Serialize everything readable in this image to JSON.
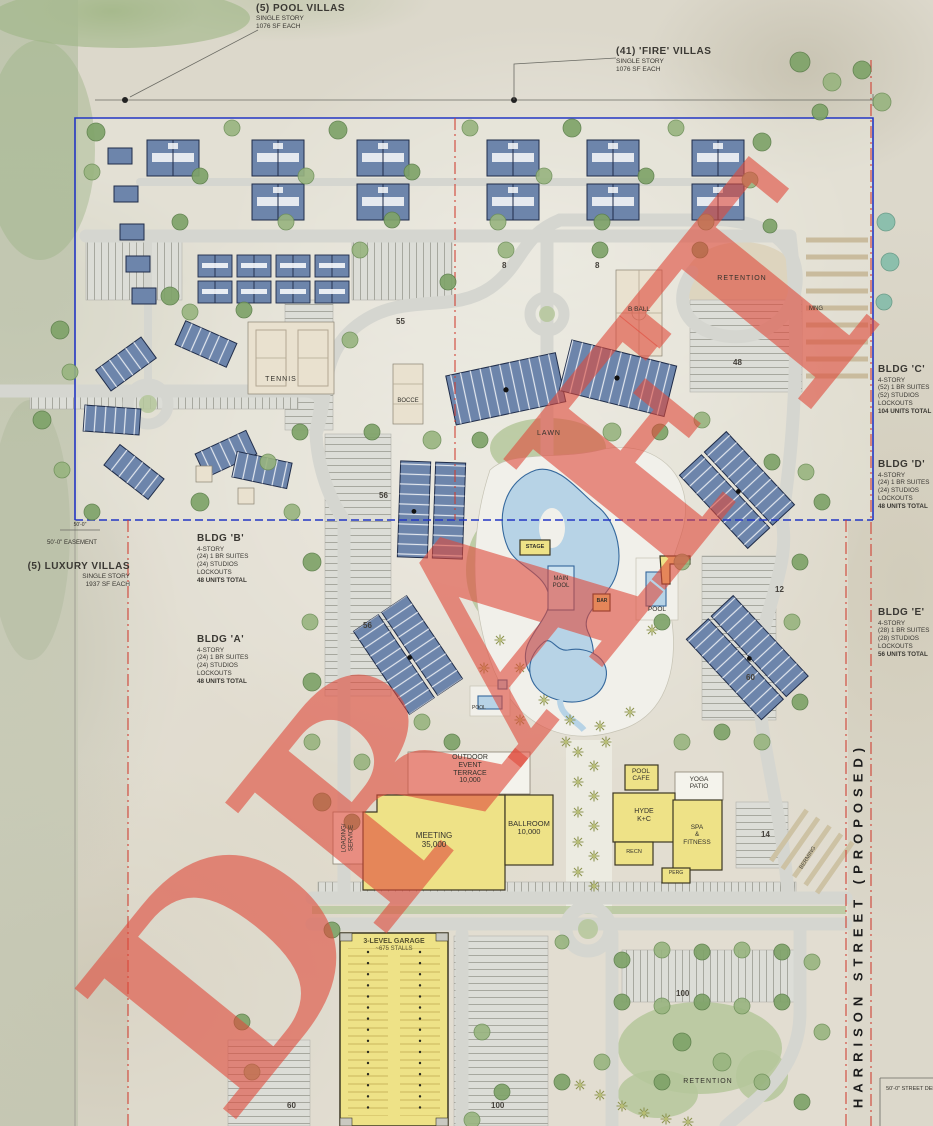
{
  "watermark": {
    "text": "DRAFT"
  },
  "notes": {
    "pool_villas": {
      "title": "(5) POOL VILLAS",
      "sub1": "SINGLE STORY",
      "sub2": "1076 SF EACH"
    },
    "fire_villas": {
      "title": "(41) 'FIRE' VILLAS",
      "sub1": "SINGLE STORY",
      "sub2": "1076 SF EACH"
    },
    "luxury_villas": {
      "title": "(5) LUXURY VILLAS",
      "sub1": "SINGLE STORY",
      "sub2": "1937 SF EACH"
    },
    "easement_dim": "50'-0\"",
    "easement": "50'-0\" EASEMENT",
    "street": "HARRISON STREET (PROPOSED)",
    "street_dedication": "50'-0\" STREET DEDI"
  },
  "building_notes": [
    {
      "name": "BLDG 'A'",
      "story": "4-STORY",
      "suites": "(24) 1 BR SUITES",
      "studios": "(24) STUDIOS",
      "lockouts": "LOCKOUTS",
      "total": "48 UNITS TOTAL"
    },
    {
      "name": "BLDG 'B'",
      "story": "4-STORY",
      "suites": "(24) 1 BR SUITES",
      "studios": "(24) STUDIOS",
      "lockouts": "LOCKOUTS",
      "total": "48 UNITS TOTAL"
    },
    {
      "name": "BLDG 'C'",
      "story": "4-STORY",
      "suites": "(52) 1 BR SUITES",
      "studios": "(52) STUDIOS",
      "lockouts": "LOCKOUTS",
      "total": "104 UNITS TOTAL"
    },
    {
      "name": "BLDG 'D'",
      "story": "4-STORY",
      "suites": "(24) 1 BR SUITES",
      "studios": "(24) STUDIOS",
      "lockouts": "LOCKOUTS",
      "total": "48 UNITS TOTAL"
    },
    {
      "name": "BLDG 'E'",
      "story": "4-STORY",
      "suites": "(28) 1 BR SUITES",
      "studios": "(28) STUDIOS",
      "lockouts": "LOCKOUTS",
      "total": "56 UNITS TOTAL"
    }
  ],
  "amenities": {
    "tennis": "TENNIS",
    "bocce": "BOCCE",
    "bball": "B BALL",
    "retention": "RETENTION",
    "mng": "MNG",
    "lawn": "LAWN",
    "stage": "STAGE",
    "main_pool_1": "MAIN",
    "main_pool_2": "POOL",
    "bar": "BAR",
    "pool": "POOL",
    "pool_small": "POOL",
    "terrace_1": "OUTDOOR",
    "terrace_2": "EVENT",
    "terrace_3": "TERRACE",
    "terrace_4": "10,000",
    "loading_1": "LOADING/",
    "loading_2": "SERVICE",
    "meeting_1": "MEETING",
    "meeting_2": "35,000",
    "ballroom_1": "BALLROOM",
    "ballroom_2": "10,000",
    "pool_cafe_1": "POOL",
    "pool_cafe_2": "CAFE",
    "hyde_1": "HYDE",
    "hyde_2": "K+C",
    "recn": "RECN",
    "yoga_1": "YOGA",
    "yoga_2": "PATIO",
    "spa_1": "SPA",
    "spa_2": "&",
    "spa_3": "FITNESS",
    "perg": "PERG",
    "garage_1": "3-LEVEL GARAGE",
    "garage_2": "~675 STALLS",
    "retention_bottom": "RETENTION",
    "berming": "BERMING"
  },
  "parking_counts": [
    "8",
    "8",
    "55",
    "48",
    "56",
    "56",
    "12",
    "60",
    "14",
    "60",
    "100",
    "100"
  ]
}
